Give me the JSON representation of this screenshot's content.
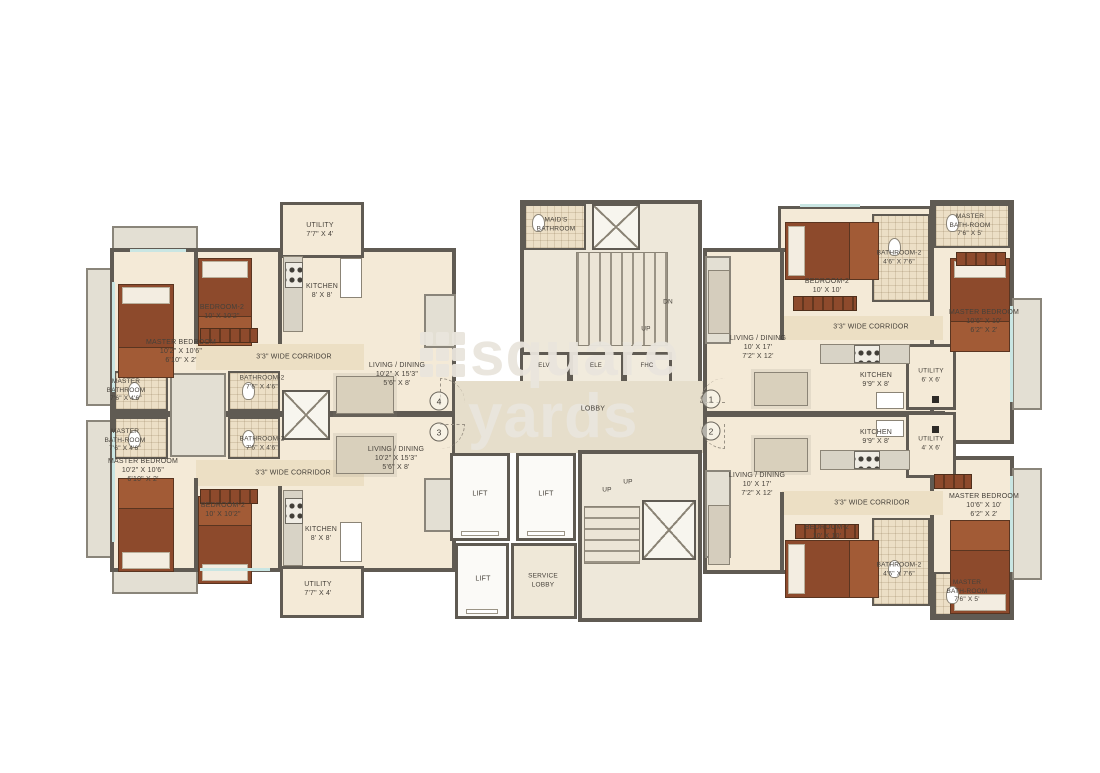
{
  "watermark": {
    "word1": "square",
    "word2": "yards"
  },
  "colors": {
    "wall": "#605b53",
    "floor": "#f4ead7",
    "corridor": "#ecdfc4",
    "tile": "#ecdfc6",
    "balcony": "#e3dfd3",
    "bed": "#8d4a2c",
    "glass": "#c9e6e3",
    "watermark": "#e9e5dc"
  },
  "core": {
    "maids_bathroom": "MAID'S\nBATHROOM",
    "stair_dn": "DN",
    "stair_up": "UP",
    "shaft_elv": "ELV",
    "shaft_ele": "ELE",
    "shaft_fhc": "FHC",
    "lobby": "LOBBY",
    "lift": "LIFT",
    "service_lobby": "SERVICE\nLOBBY",
    "stair2_up": "UP"
  },
  "units": {
    "unit4": {
      "number": "4",
      "master_bedroom": "MASTER BEDROOM\n10'2\" X 10'6\"\n6'10\" X 2'",
      "master_bathroom": "MASTER\nBATHROOM\n7'6\" X 4'6\"",
      "bedroom2": "BEDROOM-2\n10' X 10'2\"",
      "bathroom2": "BATHROOM-2\n7'6\" X 4'6\"",
      "kitchen": "KITCHEN\n8' X 8'",
      "utility": "UTILITY\n7'7\" X 4'",
      "corridor": "3'3\" WIDE CORRIDOR",
      "living": "LIVING / DINING\n10'2\" X 15'3\"\n5'6\" X 8'"
    },
    "unit3": {
      "number": "3",
      "master_bedroom": "MASTER BEDROOM\n10'2\" X 10'6\"\n6'10\" X 2'",
      "master_bathroom": "MASTER\nBATH-ROOM\n7'6\" X 4'6\"",
      "bedroom2": "BEDROOM-2\n10' X 10'2\"",
      "bathroom2": "BATHROOM-2\n7'6\" X 4'6\"",
      "kitchen": "KITCHEN\n8' X 8'",
      "utility": "UTILITY\n7'7\" X 4'",
      "corridor": "3'3\" WIDE CORRIDOR",
      "living": "LIVING / DINING\n10'2\" X 15'3\"\n5'6\" X 8'"
    },
    "unit1": {
      "number": "1",
      "master_bedroom": "MASTER BEDROOM\n10'6\" X 10'\n6'2\" X 2'",
      "master_bathroom": "MASTER\nBATH-ROOM\n7'6\" X 5'",
      "bedroom2": "BEDROOM-2\n10' X 10'",
      "bathroom2": "BATHROOM-2\n4'6\" X 7'6\"",
      "kitchen": "KITCHEN\n9'9\" X 8'",
      "utility": "UTILITY\n6' X 6'",
      "corridor": "3'3\" WIDE CORRIDOR",
      "living": "LIVING / DINING\n10' X 17'\n7'2\" X 12'"
    },
    "unit2": {
      "number": "2",
      "master_bedroom": "MASTER BEDROOM\n10'6\" X 10'\n6'2\" X 2'",
      "master_bathroom": "MASTER\nBATH-ROOM\n7'6\" X 5'",
      "bedroom2": "BEDROOM-2\n10' X 10'",
      "bathroom2": "BATHROOM-2\n4'6\" X 7'6\"",
      "kitchen": "KITCHEN\n9'9\" X 8'",
      "utility": "UTILITY\n4' X 6'",
      "corridor": "3'3\" WIDE CORRIDOR",
      "living": "LIVING / DINING\n10' X 17'\n7'2\" X 12'"
    }
  }
}
